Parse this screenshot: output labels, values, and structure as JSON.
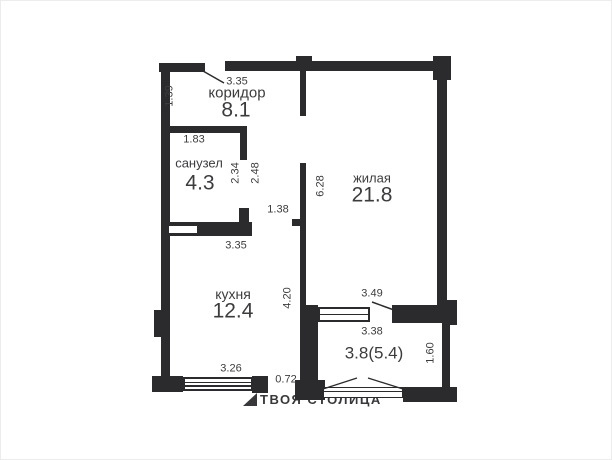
{
  "plan": {
    "rooms": {
      "koridor": {
        "name": "коридор",
        "area": "8.1"
      },
      "sanuzel": {
        "name": "санузел",
        "area": "4.3"
      },
      "zhilaya": {
        "name": "жилая",
        "area": "21.8"
      },
      "kuhnya": {
        "name": "кухня",
        "area": "12.4"
      },
      "balcony": {
        "area": "3.8(5.4)"
      }
    },
    "dims": {
      "hall_width": "3.35",
      "hall_depth": "1.39",
      "bath_width": "1.83",
      "bath_depth": "2.34",
      "passage_depth": "2.48",
      "passage_width": "1.38",
      "living_depth": "6.28",
      "kitchen_width_top": "3.35",
      "kitchen_depth": "4.20",
      "balcony_opening": "3.49",
      "balcony_width": "3.38",
      "balcony_depth": "1.60",
      "kitchen_width_bottom": "3.26",
      "kitchen_door": "0.72"
    }
  },
  "watermark": {
    "text": "ТВОЯ СТОЛИЦА"
  },
  "colors": {
    "wall": "#2b2b2d",
    "label": "#3c3c3f",
    "background": "#ffffff"
  }
}
